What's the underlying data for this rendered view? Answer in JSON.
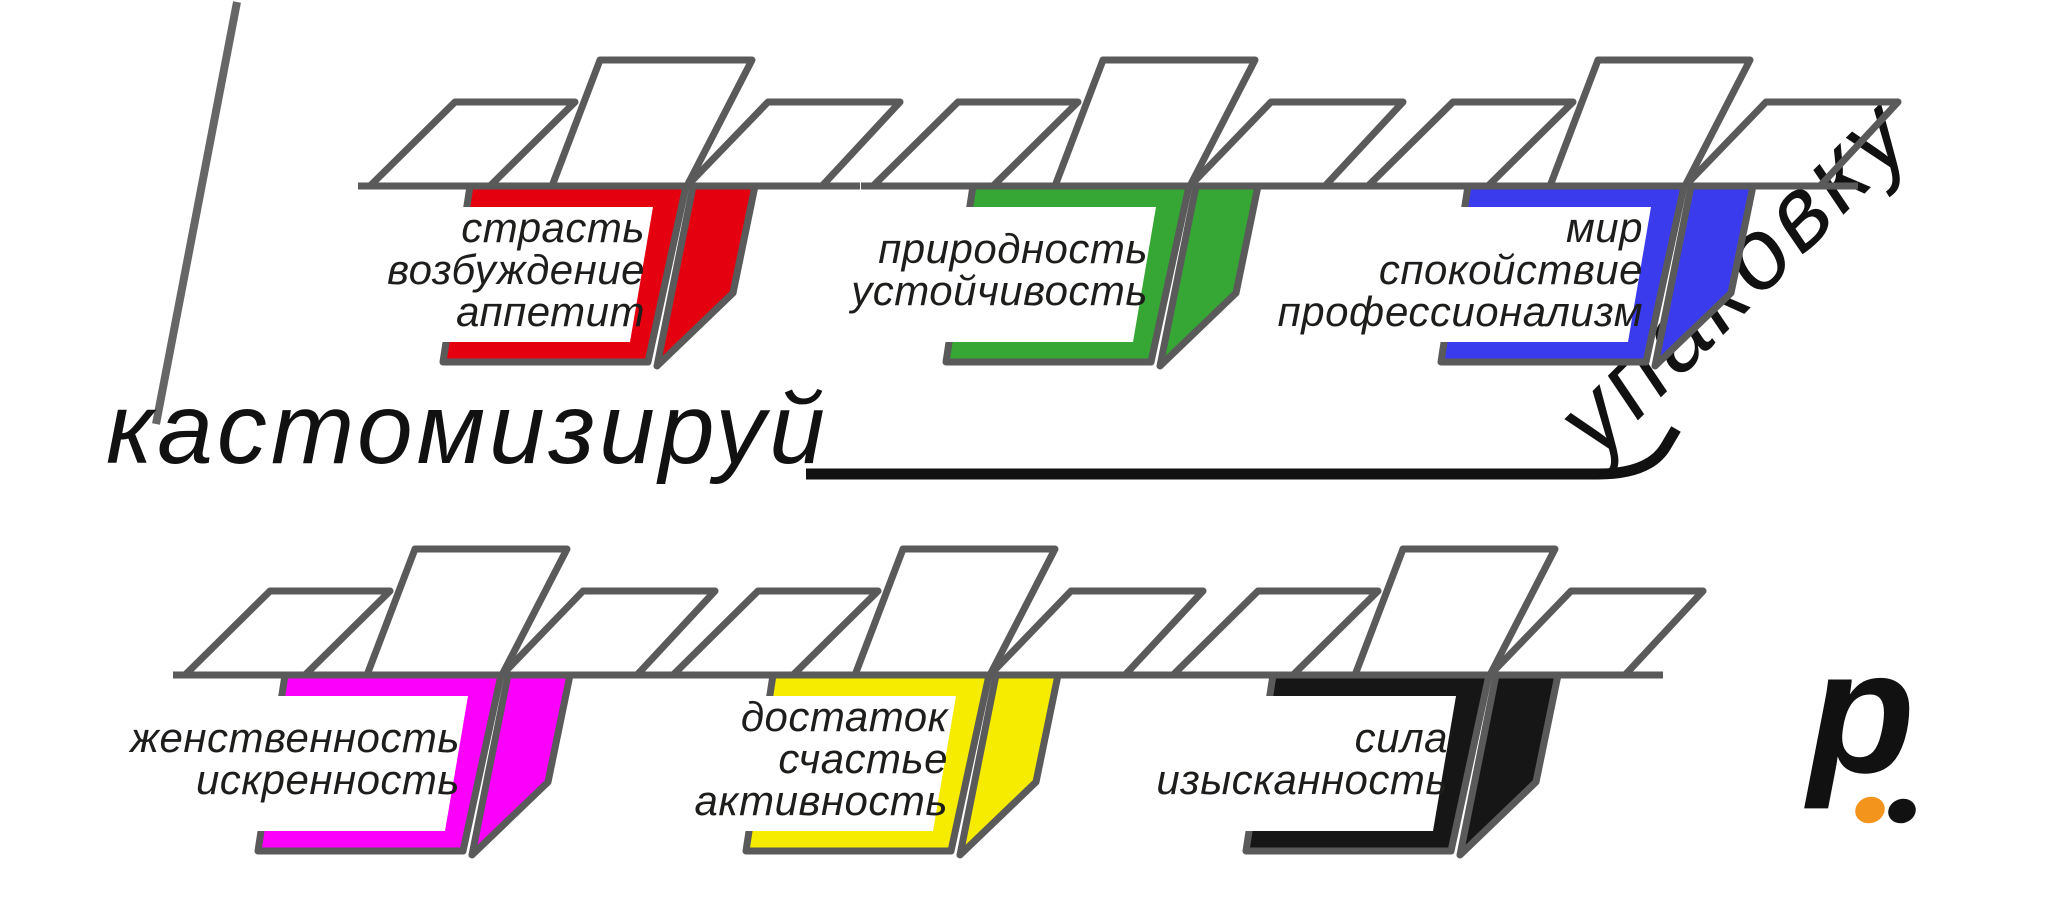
{
  "headline": {
    "word_left": "кастомизируй",
    "word_rotated": "упаковку"
  },
  "colors": {
    "outline": "#5a5a5a",
    "accent_line": "#666666",
    "underline": "#111111",
    "label_text": "#1d1d1b",
    "panel": "#ffffff"
  },
  "boxes": [
    {
      "id": "red",
      "fill": "#e50010",
      "lines": [
        "страсть",
        "возбуждение",
        "аппетит"
      ]
    },
    {
      "id": "green",
      "fill": "#36a635",
      "lines": [
        "природность",
        "устойчивость"
      ]
    },
    {
      "id": "blue",
      "fill": "#3b3bee",
      "lines": [
        "мир",
        "спокойствие",
        "профессионализм"
      ]
    },
    {
      "id": "magenta",
      "fill": "#fb00fb",
      "lines": [
        "женственность",
        "искренность"
      ]
    },
    {
      "id": "yellow",
      "fill": "#f6ec00",
      "lines": [
        "достаток",
        "счастье",
        "активность"
      ]
    },
    {
      "id": "black",
      "fill": "#161616",
      "lines": [
        "сила",
        "изысканность"
      ]
    }
  ],
  "logo": {
    "letter": "p",
    "dot_orange": "#f3941c",
    "dot_black": "#111111"
  }
}
